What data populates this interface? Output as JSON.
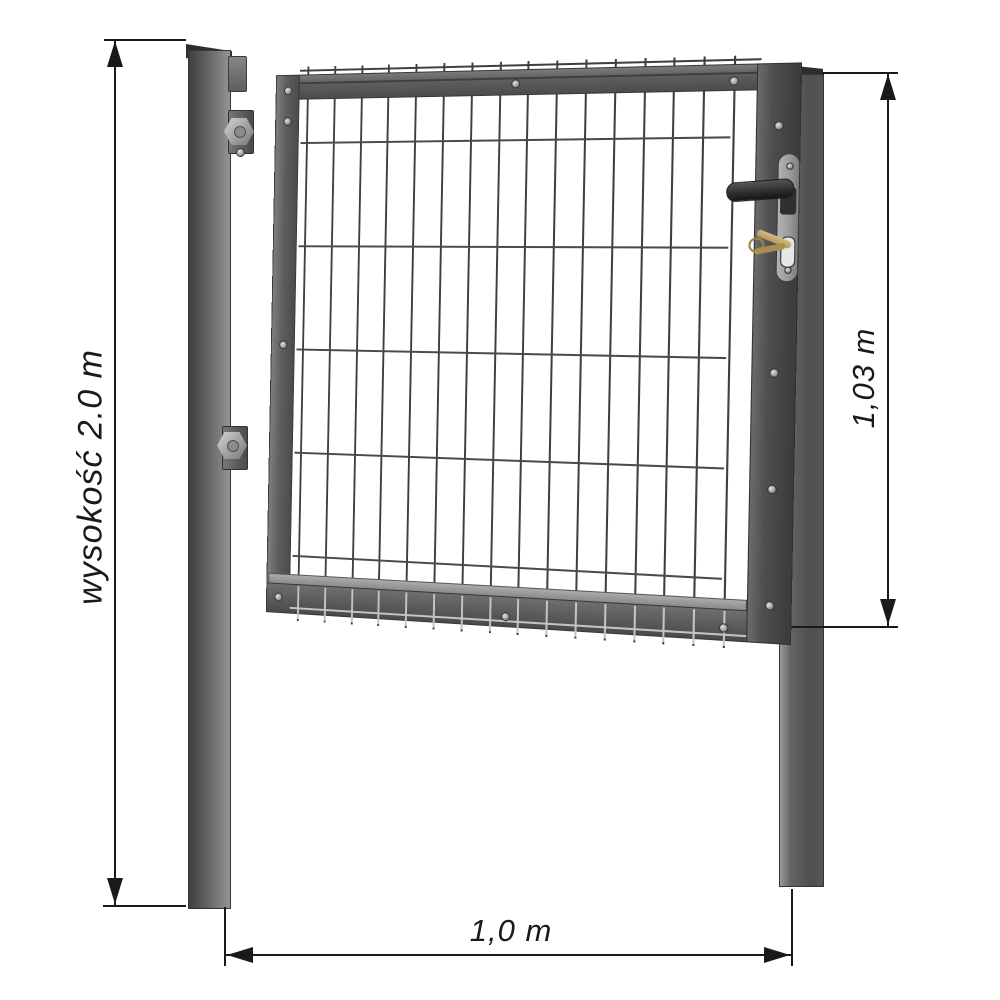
{
  "dimensions": {
    "post_height": {
      "label": "wysokość 2.0 m",
      "orientation": "vertical",
      "side": "left"
    },
    "gate_height": {
      "label": "1,03 m",
      "orientation": "vertical",
      "side": "right"
    },
    "gate_width": {
      "label": "1,0 m",
      "orientation": "horizontal",
      "side": "bottom"
    }
  },
  "gate": {
    "mesh": {
      "vertical_wires": 16,
      "horizontal_wires": 5
    }
  },
  "colors": {
    "dimension_ink": "#1a1a1a",
    "post_cap": "#2e2e2e",
    "post_dark": "#454545",
    "post_light": "#8f8f8f",
    "frame": "#5e5e5e",
    "stile": "#4f4f4f",
    "wire": "#3f3f3f",
    "wire_highlight": "#c4c4c4",
    "lock_plate": "#9b9b9b",
    "handle": "#2f2f2f",
    "keys": "#b4955a",
    "background": "#ffffff"
  }
}
